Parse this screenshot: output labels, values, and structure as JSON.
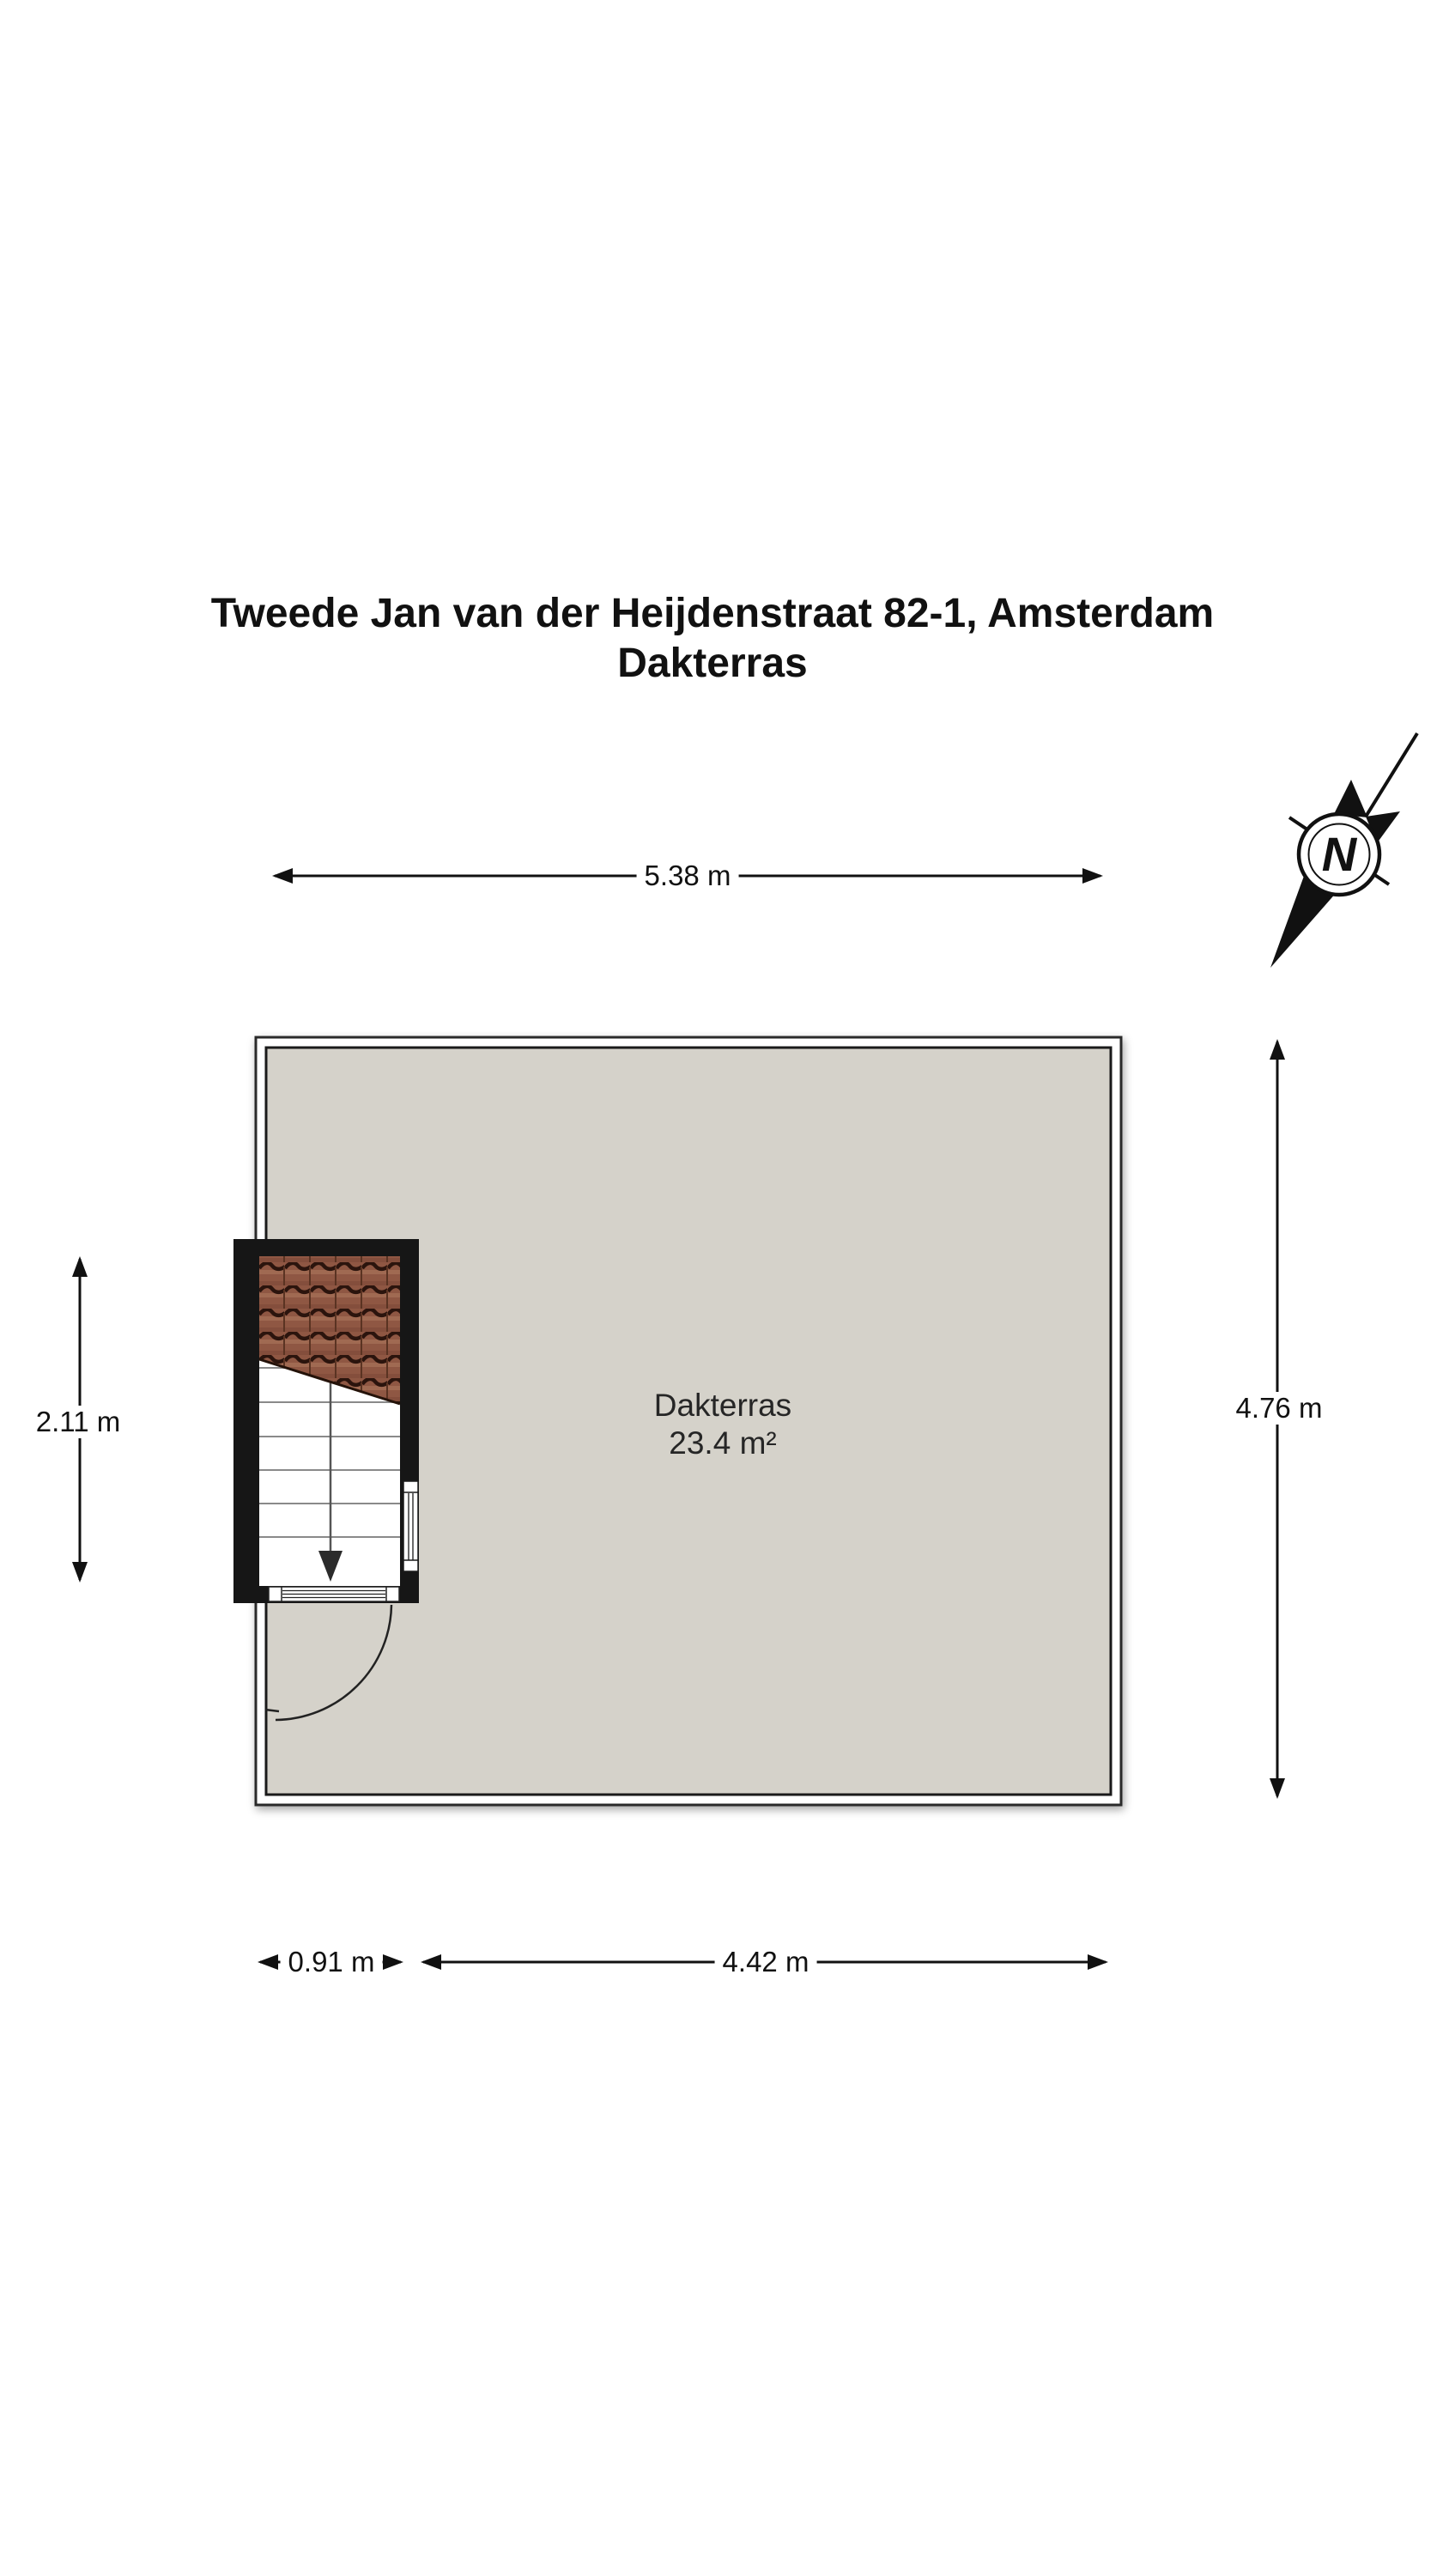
{
  "title": {
    "line1": "Tweede Jan van der Heijdenstraat 82-1, Amsterdam",
    "line2": "Dakterras"
  },
  "room": {
    "name": "Dakterras",
    "area": "23.4 m²"
  },
  "dimensions": {
    "top": "5.38 m",
    "right": "4.76 m",
    "left": "2.11 m",
    "bottom_small": "0.91 m",
    "bottom_large": "4.42 m"
  },
  "compass": {
    "north_label": "N"
  },
  "colors": {
    "floor": "#d5d2ca",
    "wall_black": "#161616",
    "outline": "#1a1a1a",
    "tile_body": "#8f5743",
    "tile_shadow": "#2b140d",
    "dimension_line": "#111111"
  }
}
